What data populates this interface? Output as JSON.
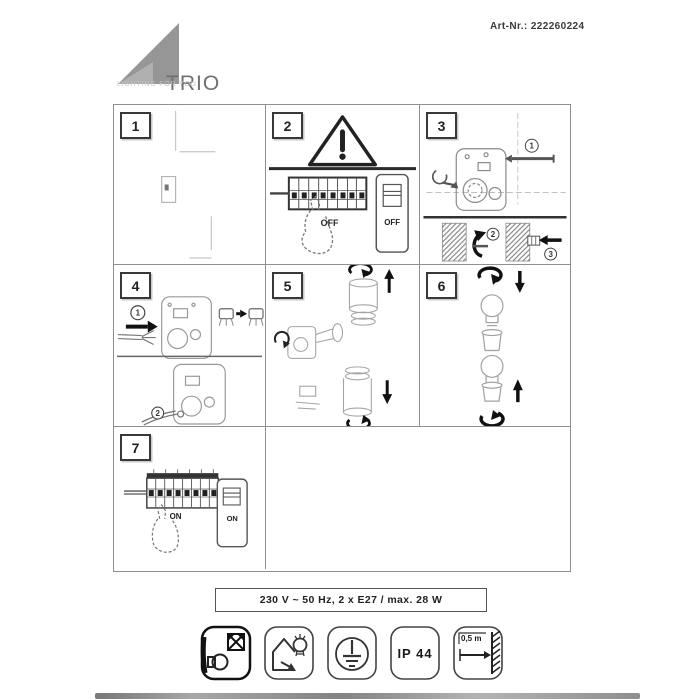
{
  "header": {
    "brand": "TRIO",
    "tagline": "LIGHTING FOR YOU",
    "art_number": "Art-Nr.: 222260224"
  },
  "colors": {
    "logo_gray": "#969696",
    "grid_line": "#8f8f8f",
    "ink_dark": "#1a1a1a",
    "ink_faint": "#b5b5b5"
  },
  "panels": {
    "p1": {
      "number": "1"
    },
    "p2": {
      "number": "2",
      "breaker_label": "OFF",
      "switch_label": "OFF"
    },
    "p3": {
      "number": "3",
      "step1": "1",
      "step2": "2",
      "step3": "3"
    },
    "p4": {
      "number": "4",
      "step1": "1",
      "step2": "2"
    },
    "p5": {
      "number": "5"
    },
    "p6": {
      "number": "6"
    },
    "p7": {
      "number": "7",
      "breaker_label": "ON",
      "switch_label": "ON"
    }
  },
  "spec": {
    "text": "230 V ~ 50 Hz, 2 x E27 / max. 28 W"
  },
  "symbols": {
    "ip_rating": "IP 44",
    "min_distance": "0,5 m"
  }
}
